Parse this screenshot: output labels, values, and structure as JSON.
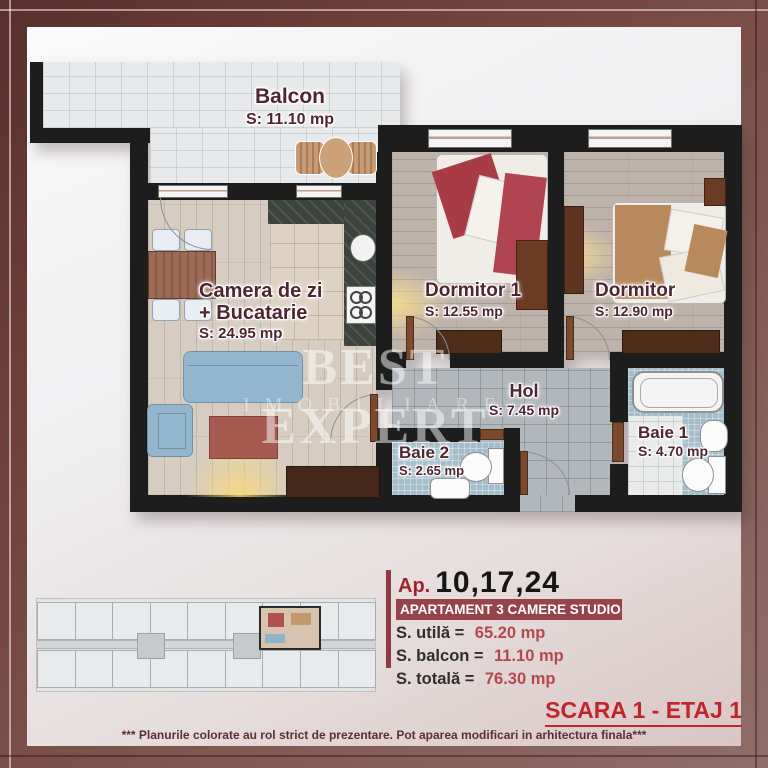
{
  "plan": {
    "watermark": {
      "line1": "BEST EXPERT",
      "line2": "IMOBILIARE"
    },
    "rooms": [
      {
        "id": "balcon",
        "name": "Balcon",
        "area": "S: 11.10 mp"
      },
      {
        "id": "living",
        "name": "Camera de zi + Bucatarie",
        "area": "S: 24.95 mp"
      },
      {
        "id": "dormitor1",
        "name": "Dormitor 1",
        "area": "S: 12.55 mp"
      },
      {
        "id": "dormitor",
        "name": "Dormitor",
        "area": "S: 12.90 mp"
      },
      {
        "id": "hol",
        "name": "Hol",
        "area": "S: 7.45 mp"
      },
      {
        "id": "baie2",
        "name": "Baie 2",
        "area": "S: 2.65 mp"
      },
      {
        "id": "baie1",
        "name": "Baie 1",
        "area": "S: 4.70 mp"
      }
    ]
  },
  "info": {
    "ap_label": "Ap.",
    "ap_numbers": "10,17,24",
    "type_label": "APARTAMENT 3 CAMERE STUDIO",
    "rows": [
      {
        "label": "S. utilă =",
        "value": "65.20 mp"
      },
      {
        "label": "S. balcon =",
        "value": "11.10 mp"
      },
      {
        "label": "S. totală =",
        "value": "76.30 mp"
      }
    ]
  },
  "footer": {
    "scara": "SCARA 1 - ETAJ 1",
    "disclaimer": "*** Planurile colorate au rol strict de prezentare. Pot aparea modificari in arhitectura finala***"
  },
  "colors": {
    "frame_maroon": "#6e403a",
    "label_maroon": "#4f2532",
    "accent_red": "#b5484e",
    "type_bar_bg": "#96434b",
    "scara_red": "#c2242c",
    "wall_black": "#1d1d1d"
  }
}
